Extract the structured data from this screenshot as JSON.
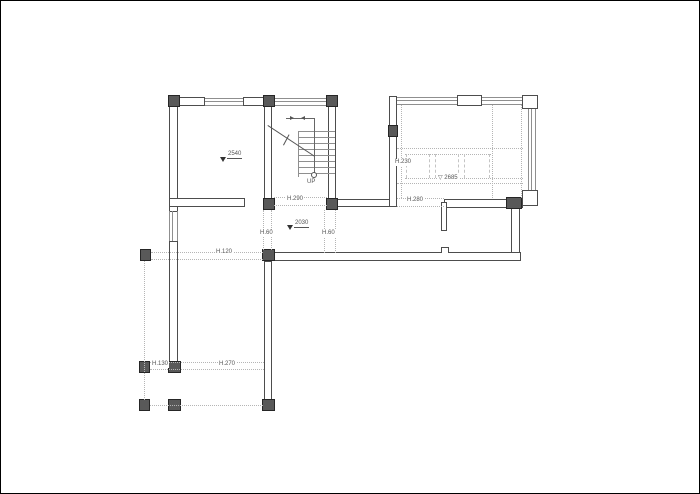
{
  "plan": {
    "labels": {
      "up": "UP",
      "level_room": "2540",
      "level_hall": "2030",
      "h290": "H.290",
      "h280": "H.280",
      "h230": "H.230",
      "ceiling": "▽ 2685",
      "h60_left": "H.60",
      "h60_right": "H.60",
      "h120": "H.120",
      "h130": "H.130",
      "h270": "H.270"
    },
    "colors": {
      "wall_line": "#4d4d4d",
      "column_fill": "#595959",
      "dotted_line": "#b5b5b5",
      "text": "#555555",
      "background": "#ffffff",
      "frame": "#000000"
    }
  }
}
